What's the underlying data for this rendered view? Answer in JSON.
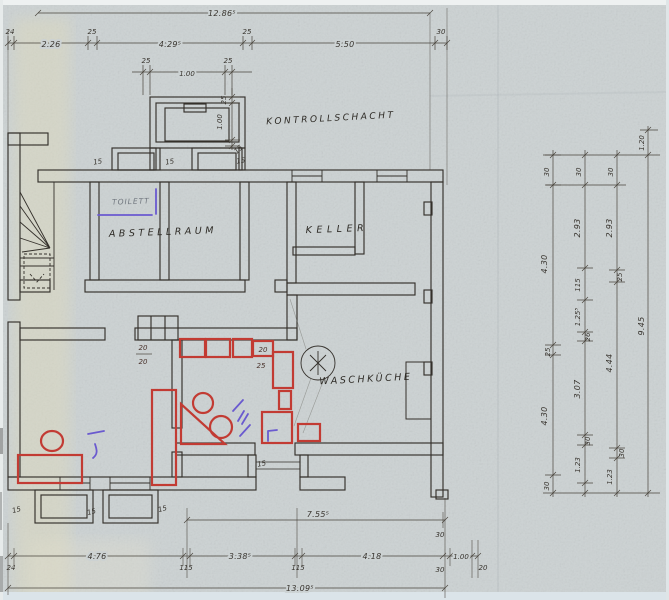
{
  "rooms": {
    "kontrollschacht": "KONTROLLSCHACHT",
    "abstellraum": "ABSTELLRAUM",
    "keller": "KELLER",
    "waschkueche": "WASCHKÜCHE",
    "toilett": "TOILETT"
  },
  "colors": {
    "ink": "#34302b",
    "dimension": "#49443c",
    "red_marker": "#c23b33",
    "blue_pen": "#6a5acf",
    "paper": "#ccd2d3"
  },
  "dims": {
    "top_total": "12.86⁵",
    "top": [
      "24",
      "2.26",
      "25",
      "4.29⁵",
      "25",
      "5.50",
      "30"
    ],
    "shaft_h": [
      "25",
      "1.00",
      "25"
    ],
    "shaft_v": [
      "25",
      "1.00",
      "15"
    ],
    "win15": "15",
    "counter": {
      "left_top": "20",
      "left_bot": "20",
      "right_top": "20",
      "right_bot": "25"
    },
    "right_c1": [
      "30",
      "4.30",
      "25",
      "4.30",
      "30"
    ],
    "right_c2": [
      "30",
      "2.93",
      "115",
      "1.25⁵",
      "26",
      "3.07",
      "30",
      "1.23"
    ],
    "right_c3": [
      "30",
      "2.93",
      "25",
      "4.44",
      "30",
      "1.23"
    ],
    "right_c4": [
      "1.20",
      "9.45"
    ],
    "bottom_755": "7.55⁵",
    "bottom": [
      "24",
      "4.76",
      "115",
      "3.38⁵",
      "115",
      "4.18"
    ],
    "bottom_30a": "30",
    "bottom_30b": "30",
    "bottom_100": "1.00",
    "bottom_20": "20",
    "bottom_total": "13.09⁵"
  }
}
